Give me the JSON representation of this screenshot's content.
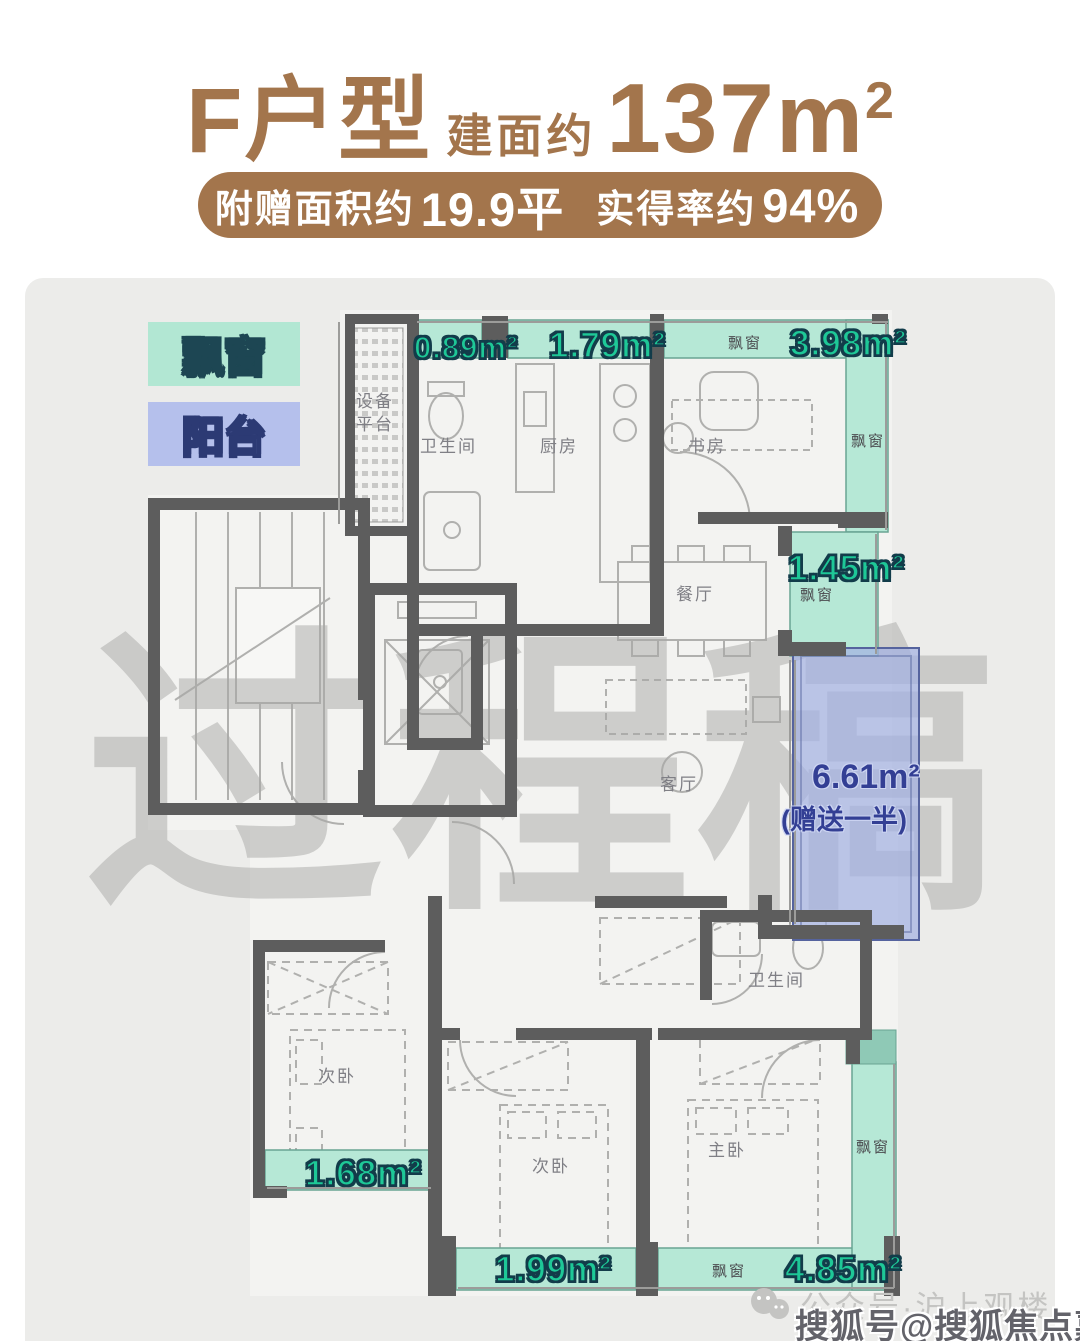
{
  "header": {
    "unit": "F户型",
    "area_label": "建面约",
    "area_value": "137m",
    "area_sup": "2",
    "banner": {
      "b1": "附赠面积约",
      "b2": "19.9平",
      "b3": "实得率约",
      "b4": "94%"
    }
  },
  "legend": {
    "bay_window": "飘窗",
    "balcony": "阳台"
  },
  "areas": {
    "top_left": "0.89m²",
    "top_mid": "1.79m²",
    "top_right": "3.98m²",
    "right_upper": "1.45m²",
    "balcony_area": "6.61m²",
    "balcony_note": "(赠送一半)",
    "bottom_left": "1.68m²",
    "bottom_mid": "1.99m²",
    "bottom_right": "4.85m²"
  },
  "bay_tags": {
    "top": "飘窗",
    "study_right": "飘窗",
    "mid_right": "飘窗",
    "master_right": "飘窗",
    "bottom": "飘窗"
  },
  "rooms": {
    "equipment": "设备平台",
    "bath1": "卫生间",
    "kitchen": "厨房",
    "study": "书房",
    "dining": "餐厅",
    "living": "客厅",
    "bath2": "卫生间",
    "bedroom_left": "次卧",
    "bedroom_mid": "次卧",
    "master": "主卧"
  },
  "watermark": "过程稿",
  "footer": {
    "wechat": "公众号·沪上观楼",
    "sohu": "搜狐号@搜狐焦点嘉峪关站"
  },
  "colors": {
    "brand_brown": "#a3754c",
    "bay_fill": "#b6e8d6",
    "bay_text": "#1ec897",
    "balcony_fill": "#a4b2e2",
    "balcony_text": "#333f94",
    "wall": "#5d5d5d",
    "panel_bg": "#ececea"
  }
}
